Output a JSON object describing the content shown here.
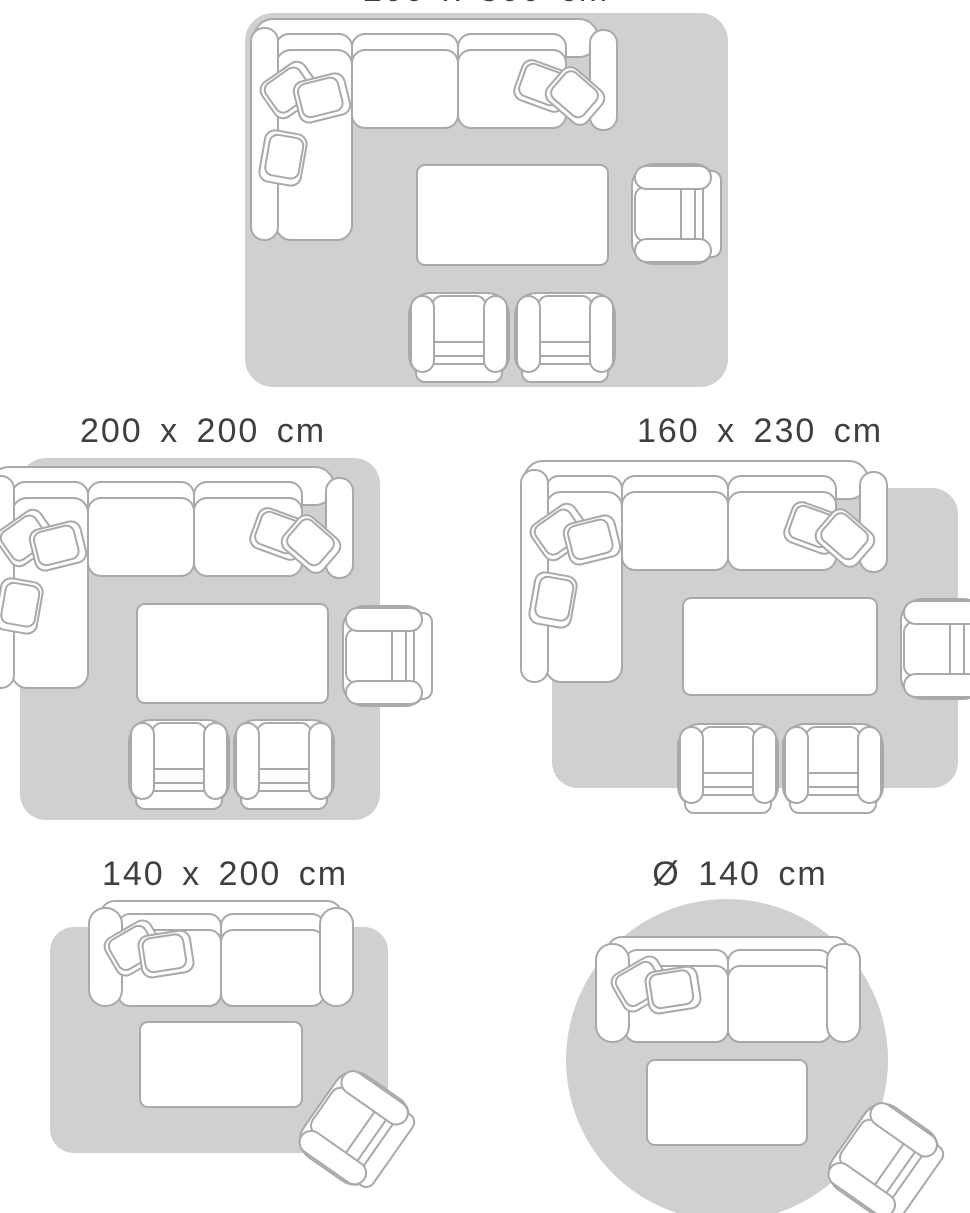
{
  "colors": {
    "background": "#ffffff",
    "rug_fill": "#d0d0d0",
    "outline": "#a9a9a9",
    "furniture_fill": "#ffffff",
    "label_text": "#3e3f41"
  },
  "panels": [
    {
      "id": "rect-200x300",
      "label": "200 x 300 cm",
      "rug_shape": "rectangle",
      "label_truncated_at_top": true,
      "furniture": [
        "sectional-sofa",
        "coffee-table",
        "side-armchair",
        "front-armchair",
        "front-armchair"
      ]
    },
    {
      "id": "rect-200x200",
      "label": "200 x 200 cm",
      "rug_shape": "rectangle",
      "furniture": [
        "sectional-sofa",
        "coffee-table",
        "side-armchair",
        "front-armchair",
        "front-armchair"
      ]
    },
    {
      "id": "rect-160x230",
      "label": "160 x 230 cm",
      "rug_shape": "rectangle",
      "furniture": [
        "sectional-sofa",
        "coffee-table",
        "side-armchair",
        "front-armchair",
        "front-armchair"
      ]
    },
    {
      "id": "rect-140x200",
      "label": "140 x 200 cm",
      "rug_shape": "rectangle",
      "furniture": [
        "two-seat-sofa",
        "coffee-table",
        "corner-armchair"
      ]
    },
    {
      "id": "round-140",
      "label": "Ø 140 cm",
      "rug_shape": "circle",
      "furniture": [
        "two-seat-sofa",
        "coffee-table",
        "corner-armchair"
      ]
    }
  ]
}
